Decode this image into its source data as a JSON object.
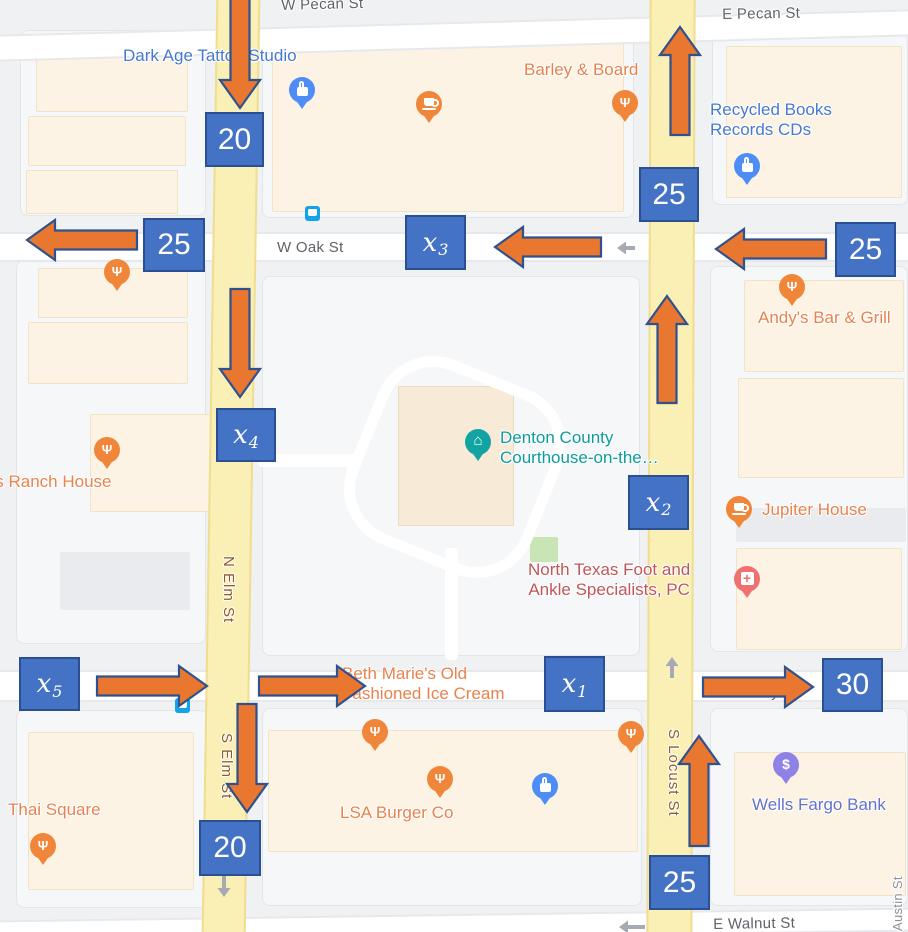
{
  "canvas": {
    "w": 908,
    "h": 932
  },
  "colors": {
    "box_blue": "#4472C4",
    "box_border": "#2A4F93",
    "arrow_orange": "#E9772F",
    "arrow_border": "#2F528F",
    "oneway_gray": "#A6ABB3",
    "road_yellow": "#FAEFB4",
    "poi_blue": "#4779D1",
    "poi_orange": "#E8824E",
    "poi_teal": "#0C9C9C",
    "poi_maroon": "#C05658",
    "poi_indigo": "#6473CC",
    "street_gray": "#5F6368",
    "street_brown": "#8F5B2C"
  },
  "roads": [
    {
      "kind": "h",
      "name": "pecan-street-road",
      "x": -12,
      "y": 22,
      "w": 932,
      "h": 27,
      "rot": -1.6
    },
    {
      "kind": "h",
      "name": "oak-street-road",
      "x": 0,
      "y": 232,
      "w": 908,
      "h": 30,
      "rot": 0
    },
    {
      "kind": "h",
      "name": "hickory-street-road",
      "x": 0,
      "y": 670,
      "w": 908,
      "h": 32,
      "rot": 0
    },
    {
      "kind": "h",
      "name": "walnut-street-road",
      "x": -10,
      "y": 914,
      "w": 928,
      "h": 24,
      "rot": -0.8
    },
    {
      "kind": "v",
      "name": "elm-street-road",
      "x": 209,
      "y": -12,
      "w": 44,
      "h": 956,
      "rot": 0.9
    },
    {
      "kind": "v",
      "name": "locust-street-road",
      "x": 648,
      "y": -12,
      "w": 46,
      "h": 956,
      "rot": 0.2
    },
    {
      "kind": "path",
      "name": "courthouse-south-path",
      "x": 445,
      "y": 548,
      "w": 13,
      "h": 112,
      "rot": 0
    },
    {
      "kind": "path",
      "name": "courthouse-west-path",
      "x": 258,
      "y": 454,
      "w": 104,
      "h": 13,
      "rot": 0
    }
  ],
  "buildings": [
    {
      "kind": "parcel",
      "x": 20,
      "y": 30,
      "w": 186,
      "h": 186
    },
    {
      "kind": "parcel",
      "x": 262,
      "y": 28,
      "w": 372,
      "h": 190
    },
    {
      "kind": "parcel",
      "x": 712,
      "y": 33,
      "w": 196,
      "h": 172
    },
    {
      "kind": "parcel",
      "x": 16,
      "y": 260,
      "w": 190,
      "h": 384
    },
    {
      "kind": "parcel",
      "x": 262,
      "y": 276,
      "w": 378,
      "h": 380
    },
    {
      "kind": "parcel",
      "x": 710,
      "y": 266,
      "w": 198,
      "h": 386
    },
    {
      "kind": "parcel",
      "x": 16,
      "y": 710,
      "w": 192,
      "h": 198
    },
    {
      "kind": "parcel",
      "x": 262,
      "y": 708,
      "w": 380,
      "h": 198
    },
    {
      "kind": "parcel",
      "x": 710,
      "y": 708,
      "w": 198,
      "h": 198
    },
    {
      "kind": "bldg",
      "x": 36,
      "y": 40,
      "w": 152,
      "h": 72
    },
    {
      "kind": "bldg",
      "x": 28,
      "y": 116,
      "w": 158,
      "h": 50
    },
    {
      "kind": "bldg",
      "x": 26,
      "y": 170,
      "w": 152,
      "h": 44
    },
    {
      "kind": "bldg",
      "x": 272,
      "y": 36,
      "w": 352,
      "h": 176
    },
    {
      "kind": "bldg",
      "x": 726,
      "y": 46,
      "w": 176,
      "h": 152
    },
    {
      "kind": "bldg",
      "x": 38,
      "y": 268,
      "w": 150,
      "h": 50
    },
    {
      "kind": "bldg",
      "x": 28,
      "y": 322,
      "w": 160,
      "h": 62
    },
    {
      "kind": "bldg",
      "x": 90,
      "y": 414,
      "w": 126,
      "h": 98
    },
    {
      "kind": "grayb",
      "x": 60,
      "y": 552,
      "w": 130,
      "h": 58
    },
    {
      "kind": "bldg",
      "x": 744,
      "y": 280,
      "w": 160,
      "h": 92
    },
    {
      "kind": "bldg",
      "x": 738,
      "y": 378,
      "w": 166,
      "h": 100
    },
    {
      "kind": "grayb",
      "x": 736,
      "y": 508,
      "w": 170,
      "h": 34
    },
    {
      "kind": "bldg",
      "x": 736,
      "y": 548,
      "w": 166,
      "h": 102
    },
    {
      "kind": "bldg",
      "x": 28,
      "y": 732,
      "w": 166,
      "h": 158
    },
    {
      "kind": "bldg",
      "x": 268,
      "y": 730,
      "w": 370,
      "h": 122
    },
    {
      "kind": "bldg",
      "x": 734,
      "y": 752,
      "w": 172,
      "h": 144
    },
    {
      "kind": "bldg2",
      "x": 398,
      "y": 386,
      "w": 116,
      "h": 140
    },
    {
      "kind": "green",
      "x": 530,
      "y": 537,
      "w": 28,
      "h": 25
    }
  ],
  "street_labels": [
    {
      "text": "W Pecan St",
      "x": 281,
      "y": -3,
      "cls": "gray",
      "rot": -1.5
    },
    {
      "text": "E Pecan St",
      "x": 722,
      "y": 6,
      "cls": "gray",
      "rot": -1
    },
    {
      "text": "W Oak St",
      "x": 277,
      "y": 239,
      "cls": "gray",
      "rot": 0
    },
    {
      "text": "E Hickory St",
      "x": 712,
      "y": 684,
      "cls": "gray",
      "rot": 0
    },
    {
      "text": "E Walnut St",
      "x": 713,
      "y": 916,
      "cls": "gray",
      "rot": -1
    },
    {
      "text": "N Elm St",
      "x": 237,
      "y": 556,
      "cls": "brown",
      "rot": 90
    },
    {
      "text": "S Elm St",
      "x": 235,
      "y": 733,
      "cls": "brown",
      "rot": 90
    },
    {
      "text": "S Locust St",
      "x": 682,
      "y": 729,
      "cls": "brown",
      "rot": 90
    },
    {
      "text": "Austin St",
      "x": 891,
      "y": 931,
      "cls": "gray2",
      "rot": -90
    }
  ],
  "poi_labels": [
    {
      "text": "Dark Age Tattoo Studio",
      "x": 123,
      "y": 46,
      "cls": "blue"
    },
    {
      "text": "Barley & Board",
      "x": 524,
      "y": 60,
      "cls": "orangeL"
    },
    {
      "text": "Recycled Books\nRecords CDs",
      "x": 710,
      "y": 100,
      "cls": "blue"
    },
    {
      "text": "Andy's Bar & Grill",
      "x": 758,
      "y": 308,
      "cls": "orangeL"
    },
    {
      "text": "'s Ranch House",
      "x": -8,
      "y": 472,
      "cls": "orangeL"
    },
    {
      "text": "Denton County\nCourthouse-on-the…",
      "x": 500,
      "y": 428,
      "cls": "teal"
    },
    {
      "text": "Jupiter House",
      "x": 762,
      "y": 500,
      "cls": "orangeL"
    },
    {
      "text": "North Texas Foot and\nAnkle Specialists, PC",
      "x": 528,
      "y": 560,
      "cls": "maroon ctr"
    },
    {
      "text": "Beth Marie's Old\nFashioned Ice Cream",
      "x": 342,
      "y": 664,
      "cls": "orangeL"
    },
    {
      "text": "Thai Square",
      "x": 8,
      "y": 800,
      "cls": "orangeL"
    },
    {
      "text": "LSA Burger Co",
      "x": 340,
      "y": 803,
      "cls": "orangeL"
    },
    {
      "text": "Wells Fargo Bank",
      "x": 752,
      "y": 795,
      "cls": "indigo"
    }
  ],
  "glyphs": {
    "restaurant": "Ψ",
    "museum": "⌂",
    "hospital": "+",
    "dollar": "$"
  },
  "pins": [
    {
      "kind": "shopping",
      "x": 302,
      "y": 90
    },
    {
      "kind": "coffee",
      "x": 429,
      "y": 104
    },
    {
      "kind": "restaurant",
      "x": 625,
      "y": 103
    },
    {
      "kind": "shopping",
      "x": 747,
      "y": 166
    },
    {
      "kind": "restaurant",
      "x": 117,
      "y": 272
    },
    {
      "kind": "restaurant",
      "x": 792,
      "y": 287
    },
    {
      "kind": "restaurant",
      "x": 107,
      "y": 450
    },
    {
      "kind": "museum",
      "x": 478,
      "y": 442
    },
    {
      "kind": "coffee",
      "x": 739,
      "y": 509
    },
    {
      "kind": "hospital",
      "x": 747,
      "y": 579
    },
    {
      "kind": "restaurant",
      "x": 375,
      "y": 732
    },
    {
      "kind": "restaurant",
      "x": 440,
      "y": 779
    },
    {
      "kind": "shopping",
      "x": 545,
      "y": 786
    },
    {
      "kind": "restaurant",
      "x": 631,
      "y": 734
    },
    {
      "kind": "dollar",
      "x": 786,
      "y": 765
    },
    {
      "kind": "restaurant",
      "x": 43,
      "y": 846
    },
    {
      "kind": "transit",
      "x": 312,
      "y": 213
    },
    {
      "kind": "transit",
      "x": 182,
      "y": 705
    }
  ],
  "flow": {
    "boxes": [
      {
        "label": "20",
        "x": 205,
        "y": 112,
        "w": 59,
        "h": 55
      },
      {
        "label": "25",
        "x": 143,
        "y": 218,
        "w": 62,
        "h": 54
      },
      {
        "var": "x",
        "sub": "3",
        "x": 405,
        "y": 215,
        "w": 61,
        "h": 55
      },
      {
        "label": "25",
        "x": 639,
        "y": 167,
        "w": 60,
        "h": 55
      },
      {
        "label": "25",
        "x": 835,
        "y": 222,
        "w": 61,
        "h": 55
      },
      {
        "var": "x",
        "sub": "4",
        "x": 216,
        "y": 408,
        "w": 60,
        "h": 54
      },
      {
        "var": "x",
        "sub": "2",
        "x": 628,
        "y": 475,
        "w": 61,
        "h": 55
      },
      {
        "var": "x",
        "sub": "5",
        "x": 19,
        "y": 657,
        "w": 61,
        "h": 54
      },
      {
        "var": "x",
        "sub": "1",
        "x": 544,
        "y": 656,
        "w": 61,
        "h": 56
      },
      {
        "label": "30",
        "x": 822,
        "y": 658,
        "w": 61,
        "h": 54
      },
      {
        "label": "20",
        "x": 199,
        "y": 820,
        "w": 62,
        "h": 56
      },
      {
        "label": "25",
        "x": 649,
        "y": 855,
        "w": 61,
        "h": 55
      }
    ],
    "arrows": [
      {
        "dir": "down",
        "tip": [
          240,
          108
        ],
        "len": 112
      },
      {
        "dir": "left",
        "tip": [
          27,
          240
        ],
        "len": 110
      },
      {
        "dir": "down",
        "tip": [
          240,
          397
        ],
        "len": 108
      },
      {
        "dir": "left",
        "tip": [
          495,
          247
        ],
        "len": 106
      },
      {
        "dir": "left",
        "tip": [
          716,
          249
        ],
        "len": 110
      },
      {
        "dir": "up",
        "tip": [
          680,
          27
        ],
        "len": 108
      },
      {
        "dir": "up",
        "tip": [
          667,
          296
        ],
        "len": 107
      },
      {
        "dir": "right",
        "tip": [
          207,
          686
        ],
        "len": 110
      },
      {
        "dir": "right",
        "tip": [
          365,
          686
        ],
        "len": 106
      },
      {
        "dir": "right",
        "tip": [
          813,
          687
        ],
        "len": 110
      },
      {
        "dir": "down",
        "tip": [
          247,
          812
        ],
        "len": 108
      },
      {
        "dir": "up",
        "tip": [
          699,
          736
        ],
        "len": 110
      }
    ],
    "oneway_arrows": [
      {
        "dir": "left",
        "tip": [
          617,
          248
        ],
        "len": 18
      },
      {
        "dir": "up",
        "tip": [
          672,
          657
        ],
        "len": 21
      },
      {
        "dir": "down",
        "tip": [
          224,
          897
        ],
        "len": 21
      },
      {
        "dir": "left",
        "tip": [
          619,
          927
        ],
        "len": 26
      }
    ]
  }
}
